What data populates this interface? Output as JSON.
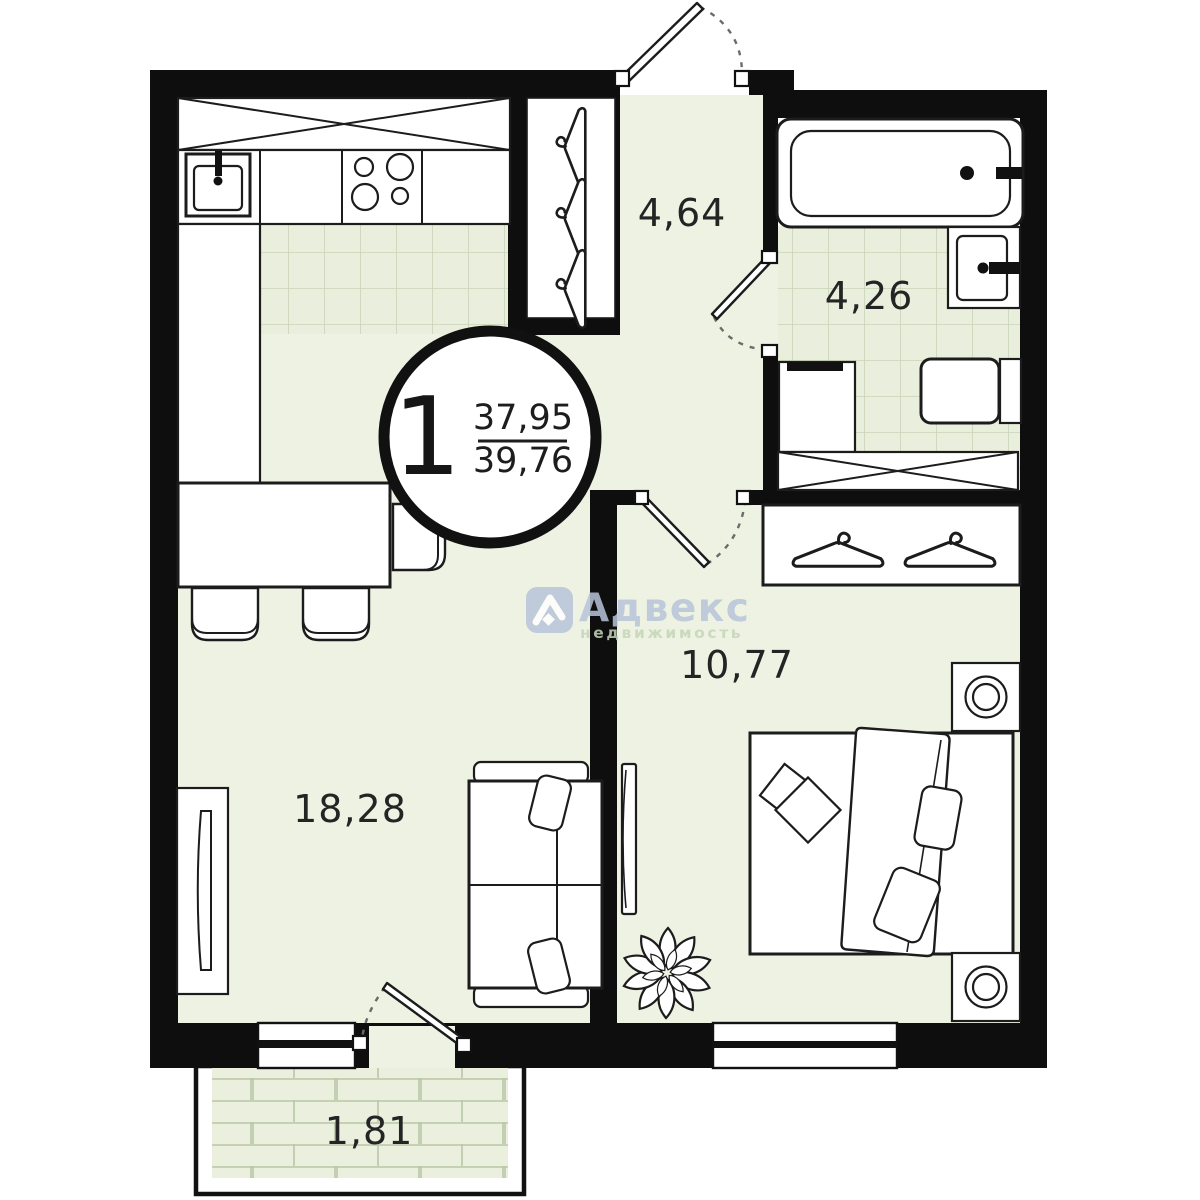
{
  "badge": {
    "rooms_count": "1",
    "area_total": "37,95",
    "area_living": "39,76"
  },
  "rooms": [
    {
      "name": "kitchen-living-room",
      "area_label": "18,28"
    },
    {
      "name": "hallway",
      "area_label": "4,64"
    },
    {
      "name": "bathroom",
      "area_label": "4,26"
    },
    {
      "name": "bedroom",
      "area_label": "10,77"
    },
    {
      "name": "balcony",
      "area_label": "1,81"
    }
  ],
  "watermark": {
    "brand": "Адвекс",
    "subtitle": "недвижимость"
  },
  "furniture_icons": [
    "kitchen-sink",
    "stove",
    "upper-cabinet",
    "dining-table",
    "chair",
    "coat-hanger",
    "bathtub",
    "washbasin",
    "washing-machine",
    "toilet",
    "storage-cabinet",
    "wardrobe-hanger",
    "bed",
    "pillow",
    "nightstand-lamp",
    "tv",
    "sofa",
    "plant",
    "radiator",
    "window",
    "door"
  ],
  "colors": {
    "wall": "#0e0e0e",
    "floor": "#edf2e2",
    "tile": "#e9efdc",
    "tile_line": "#c7d4b8",
    "brick_line": "#b9c7a8",
    "outline": "#1c1c1c",
    "watermark_blue": "#b7c4d9",
    "watermark_green": "#c6d6ba"
  }
}
